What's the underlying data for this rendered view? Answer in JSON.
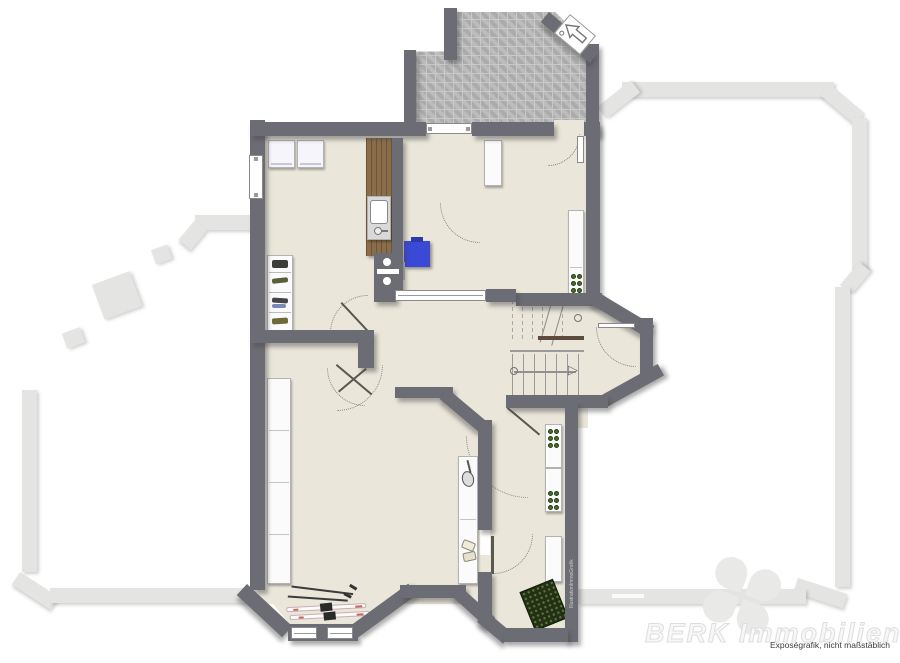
{
  "document": {
    "type": "floor-plan"
  },
  "branding": {
    "watermark": "BERK Immobilien",
    "disclaimer": "Exposégrafik, nicht maßstäblich",
    "vertical_credit": "IllustrationImmoGrafik"
  },
  "colors": {
    "wall": "#6c6c74",
    "floor": "#eae6da",
    "terrace_paving": "#b6b6b6",
    "garden_outline": "#e4e4e2",
    "boiler_blue": "#3a49d6",
    "wood_counter": "#8a6e4b",
    "plant_dots": "#4a6b30",
    "doormat": "#243015"
  },
  "icons": [
    "entrance-arrow-icon",
    "clover-logo-icon",
    "stair-direction-arrow-icon"
  ],
  "features": {
    "furniture": [
      "washing-machine",
      "washing-machine",
      "kitchen-counter-with-sink",
      "boiler",
      "wall-cabinet",
      "tall-cabinet",
      "shoe-rack",
      "wardrobe",
      "shelf-with-racket",
      "hall-cabinet",
      "hall-cabinet",
      "hall-cabinet",
      "doormat",
      "skis",
      "staircase"
    ]
  }
}
